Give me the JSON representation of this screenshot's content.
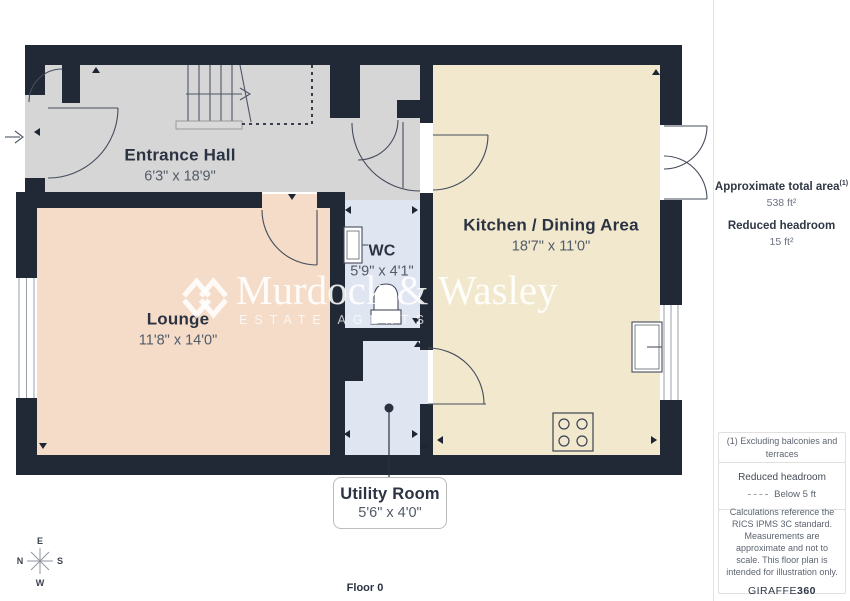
{
  "floorplan": {
    "floor_label": "Floor 0",
    "rooms": [
      {
        "name": "Entrance Hall",
        "dims": "6'3\" x 18'9\""
      },
      {
        "name": "Lounge",
        "dims": "11'8\" x 14'0\""
      },
      {
        "name": "WC",
        "dims": "5'9\" x 4'1\""
      },
      {
        "name": "Kitchen / Dining Area",
        "dims": "18'7\" x 11'0\""
      },
      {
        "name": "Utility Room",
        "dims": "5'6\" x 4'0\""
      }
    ],
    "compass": {
      "top": "E",
      "right": "S",
      "bottom": "W",
      "left": "N"
    }
  },
  "watermark": {
    "name": "Murdock & Wasley",
    "subtitle": "ESTATE AGENTS"
  },
  "sidebar": {
    "area_label": "Approximate total area",
    "area_footnote_marker": "(1)",
    "area_value": "538 ft²",
    "headroom_label": "Reduced headroom",
    "headroom_value": "15 ft²",
    "footnote": "(1) Excluding balconies and terraces",
    "legend_title": "Reduced headroom",
    "legend_item": "Below 5 ft",
    "disclaimer": "Calculations reference the RICS IPMS 3C standard. Measurements are approximate and not to scale. This floor plan is intended for illustration only.",
    "brand_name": "GIRAFFE",
    "brand_suffix": "360"
  },
  "colors": {
    "wall": "#212936",
    "hall_floor": "#d6d6d6",
    "lounge_floor": "#f5dcc9",
    "kitchen_floor": "#f1e8ce",
    "wet_floor": "#e0e5f2"
  }
}
